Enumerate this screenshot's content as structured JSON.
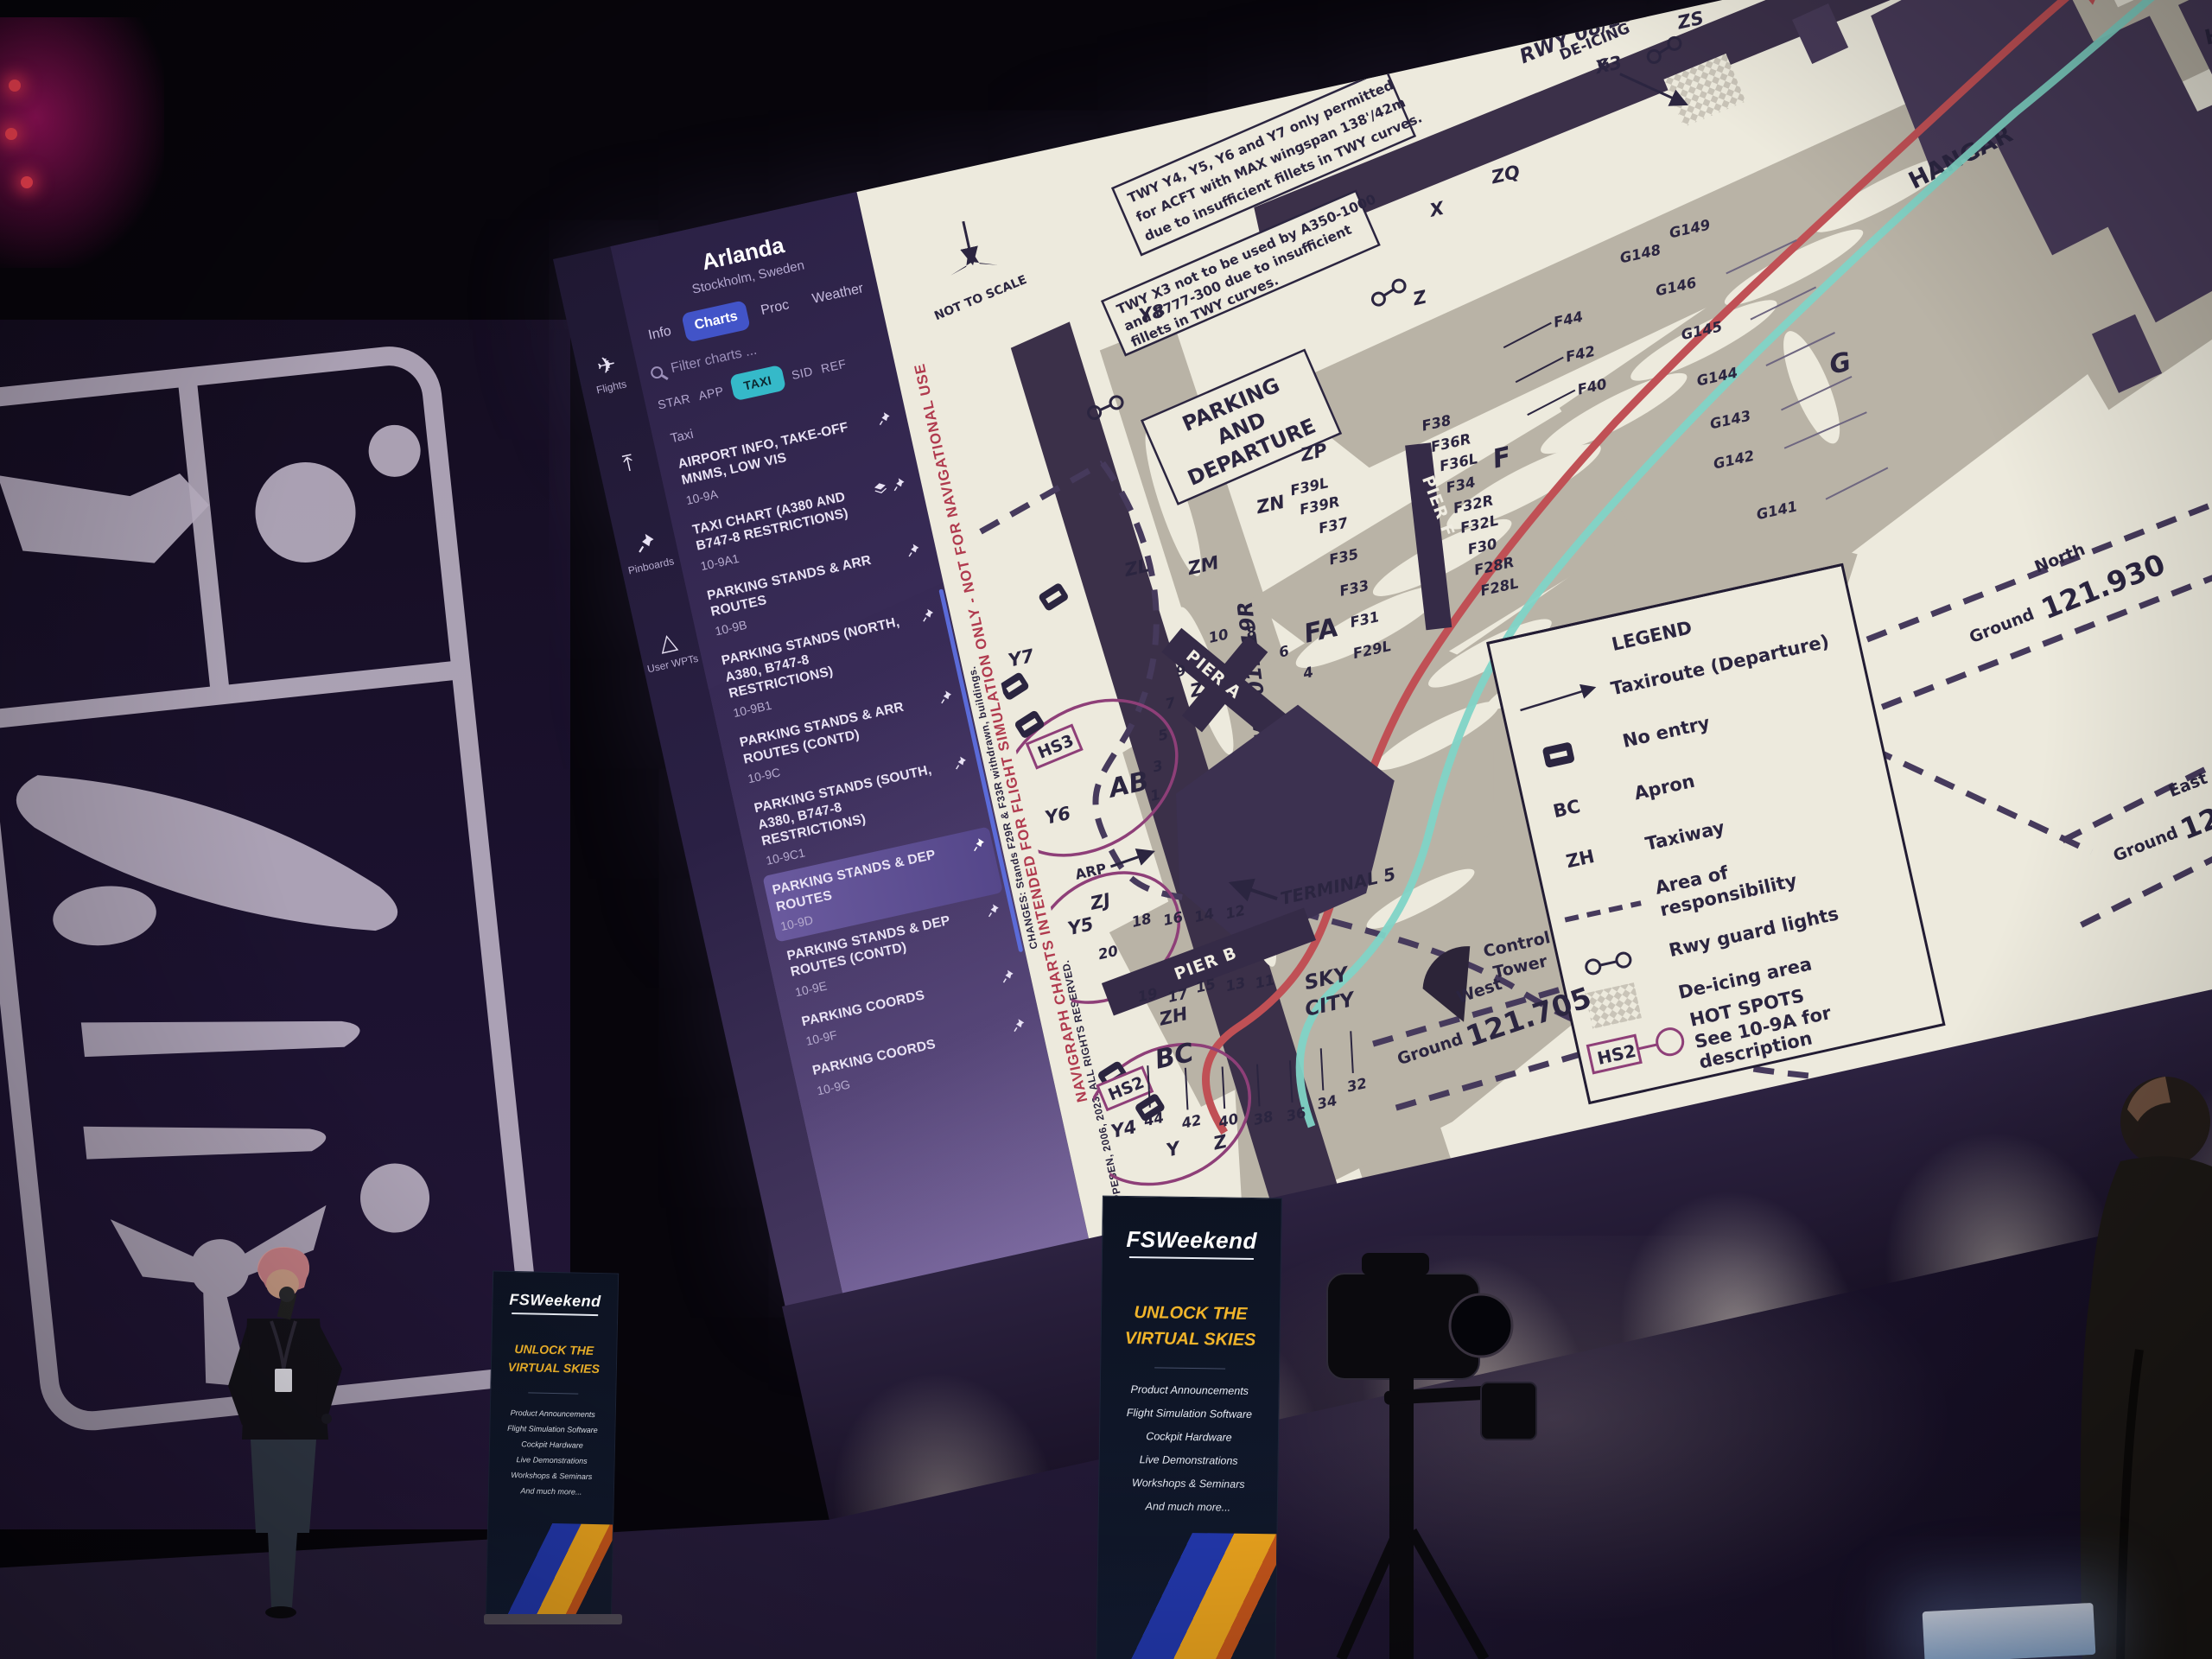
{
  "colors": {
    "accent_teal": "#35b9c9",
    "accent_indigo": "#4254c8",
    "sidebar_selected": "#6a5a9e",
    "route_red": "#c05055",
    "route_teal": "#7fd4c6",
    "hotspot_magenta": "#8e3f78"
  },
  "app": {
    "rail": {
      "flights": "Flights",
      "pinboards": "Pinboards",
      "user_wpts": "User WPTs"
    },
    "header": {
      "airport": "Arlanda",
      "location": "Stockholm, Sweden"
    },
    "tabs": {
      "info": "Info",
      "charts": "Charts",
      "proc": "Proc",
      "weather": "Weather"
    },
    "search": {
      "placeholder": "Filter charts ..."
    },
    "chips": {
      "star": "STAR",
      "app": "APP",
      "taxi": "TAXI",
      "sid": "SID",
      "ref": "REF"
    },
    "section": "Taxi",
    "list": [
      {
        "title": "AIRPORT INFO, TAKE-OFF MNMS, LOW VIS",
        "code": "10-9A"
      },
      {
        "title": "TAXI CHART (A380 AND B747-8 RESTRICTIONS)",
        "code": "10-9A1"
      },
      {
        "title": "PARKING STANDS & ARR ROUTES",
        "code": "10-9B"
      },
      {
        "title": "PARKING STANDS (NORTH, A380, B747-8 RESTRICTIONS)",
        "code": "10-9B1"
      },
      {
        "title": "PARKING STANDS & ARR ROUTES (CONTD)",
        "code": "10-9C"
      },
      {
        "title": "PARKING STANDS (SOUTH, A380, B747-8 RESTRICTIONS)",
        "code": "10-9C1"
      },
      {
        "title": "PARKING STANDS & DEP ROUTES",
        "code": "10-9D"
      },
      {
        "title": "PARKING STANDS & DEP ROUTES (CONTD)",
        "code": "10-9E"
      },
      {
        "title": "PARKING COORDS",
        "code": "10-9F"
      },
      {
        "title": "PARKING COORDS",
        "code": "10-9G"
      }
    ]
  },
  "chart": {
    "margin": {
      "changes": "CHANGES: Stands F29R & F33R withdrawn, buildings.",
      "sim_notice": "NAVIGRAPH CHARTS INTENDED FOR FLIGHT SIMULATION ONLY - NOT FOR NAVIGATIONAL USE",
      "copyright": "© JEPPESEN, 2006, 2023. ALL RIGHTS RESERVED."
    },
    "not_to_scale": "NOT TO SCALE",
    "title_lines": [
      "PARKING",
      "AND",
      "DEPARTURE"
    ],
    "note1_lines": [
      "TWY Y4, Y5, Y6 and Y7 only permitted",
      "for ACFT with MAX wingspan 138'/42m",
      "due to insufficient fillets in TWY curves."
    ],
    "note2_lines": [
      "TWY X3 not to be used by A350-1000",
      "and B777-300 due to insufficient",
      "fillets in TWY curves."
    ],
    "runways": {
      "r1": "RWY 01L/19R",
      "r2": "RWY 08/26"
    },
    "labels": {
      "hangar": "HANGAR",
      "h": "H",
      "terminal": "TERMINAL 5",
      "sky": "SKY",
      "city": "CITY",
      "control": "Control",
      "tower": "Tower",
      "deicing1": "DE-ICING",
      "deicing2": "G",
      "arp": "ARP",
      "pier_a": "PIER A",
      "pier_b": "PIER B",
      "pier_f": "PIER F",
      "fa": "FA",
      "f": "F",
      "g": "G",
      "ab": "AB",
      "bc": "BC"
    },
    "twy": {
      "x": "X",
      "x3": "X3",
      "z": "Z",
      "zq": "ZQ",
      "zs": "ZS",
      "zp": "ZP",
      "zn": "ZN",
      "zm": "ZM",
      "zl": "ZL",
      "zk": "ZK",
      "zj": "ZJ",
      "zh": "ZH",
      "y": "Y",
      "y4": "Y4",
      "y5": "Y5",
      "y6": "Y6",
      "y7": "Y7",
      "y8": "Y8"
    },
    "hotspots": {
      "hs3": "HS3",
      "hs2": "HS2"
    },
    "gates": {
      "f_right": [
        "F38",
        "F36R",
        "F36L",
        "F34",
        "F32R",
        "F32L",
        "F30",
        "F28R",
        "F28L"
      ],
      "f_left": [
        "F39L",
        "F39R",
        "F37",
        "F35",
        "F33",
        "F31",
        "F29L"
      ],
      "f_row": [
        "F44",
        "F42",
        "F40"
      ],
      "g_col": [
        "G149",
        "G148",
        "G146",
        "G145",
        "G144",
        "G143",
        "G142",
        "G141"
      ],
      "a_left": [
        "9",
        "7",
        "5",
        "3",
        "1"
      ],
      "a_right": [
        "10",
        "8",
        "6",
        "4"
      ],
      "b_top": [
        "18",
        "16",
        "14",
        "12"
      ],
      "b_mid": [
        "20",
        "19",
        "17",
        "15",
        "13",
        "11"
      ],
      "b_bottom": [
        "44",
        "42",
        "40",
        "38",
        "36",
        "34",
        "32"
      ]
    },
    "freq": {
      "north": {
        "area": "North",
        "station": "Ground",
        "value": "121.930"
      },
      "east": {
        "area": "East",
        "station": "Ground",
        "value": "121."
      },
      "west": {
        "area": "West",
        "station": "Ground",
        "value": "121.705"
      }
    },
    "legend": {
      "title": "LEGEND",
      "rows": [
        {
          "l1": "Taxiroute (Departure)"
        },
        {
          "l1": "No entry"
        },
        {
          "sym": "BC",
          "l1": "Apron"
        },
        {
          "sym": "ZH",
          "l1": "Taxiway"
        },
        {
          "l1": "Area of",
          "l2": "responsibility"
        },
        {
          "l1": "Rwy guard lights"
        },
        {
          "l1": "De-icing area"
        },
        {
          "sym": "HS2",
          "l1": "HOT SPOTS",
          "l2": "See 10-9A for",
          "l3": "description"
        }
      ]
    }
  },
  "banner": {
    "logo": "FSWeekend",
    "headline": [
      "UNLOCK THE",
      "VIRTUAL SKIES"
    ],
    "items": [
      "Product Announcements",
      "Flight Simulation Software",
      "Cockpit Hardware",
      "Live Demonstrations",
      "Workshops & Seminars",
      "And much more..."
    ],
    "footer": "AVIODROME"
  }
}
